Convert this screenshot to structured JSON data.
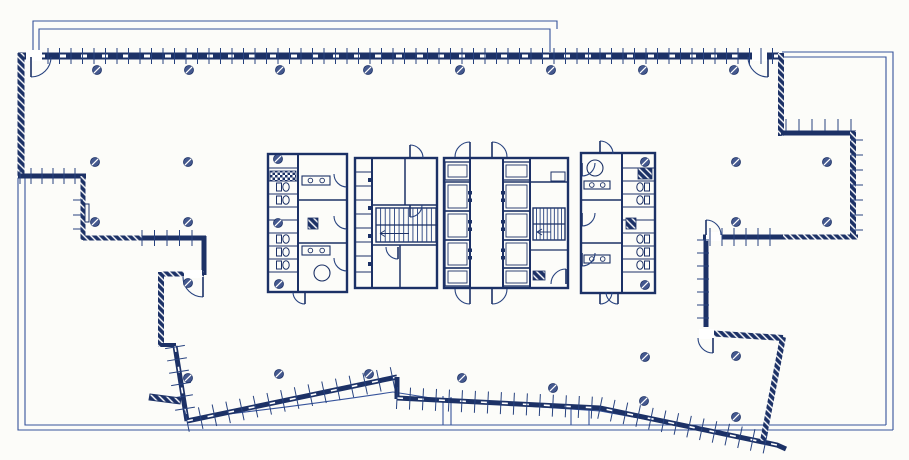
{
  "meta": {
    "drawing_type": "architectural-floor-plan",
    "style": "blueprint-linework"
  },
  "canvas": {
    "w": 909,
    "h": 460
  },
  "colors": {
    "background": "#fcfcf9",
    "wall": "#1c3166",
    "medium": "#27427f",
    "thin": "#36539b",
    "column_fill": "#44588e",
    "white": "#ffffff"
  },
  "thin_lines": [
    {
      "pts": [
        [
          33,
          53
        ],
        [
          33,
          21
        ],
        [
          557,
          21
        ],
        [
          557,
          29
        ]
      ]
    },
    {
      "pts": [
        [
          39,
          53
        ],
        [
          39,
          29
        ],
        [
          550,
          29
        ],
        [
          550,
          52
        ]
      ]
    },
    {
      "pts": [
        [
          782,
          52
        ],
        [
          893,
          52
        ],
        [
          893,
          430
        ]
      ]
    },
    {
      "pts": [
        [
          782,
          57
        ],
        [
          886,
          57
        ],
        [
          886,
          425
        ]
      ]
    },
    {
      "pts": [
        [
          18,
          178
        ],
        [
          18,
          430
        ],
        [
          893,
          430
        ]
      ]
    },
    {
      "pts": [
        [
          25,
          178
        ],
        [
          25,
          425
        ],
        [
          886,
          425
        ]
      ]
    },
    {
      "pts": [
        [
          393,
          392
        ],
        [
          450,
          401
        ],
        [
          600,
          411
        ],
        [
          765,
          441
        ]
      ]
    },
    {
      "pts": [
        [
          443,
          396
        ],
        [
          443,
          425
        ]
      ]
    },
    {
      "pts": [
        [
          451,
          397
        ],
        [
          451,
          425
        ]
      ]
    },
    {
      "pts": [
        [
          571,
          409
        ],
        [
          571,
          425
        ]
      ]
    },
    {
      "pts": [
        [
          589,
          410
        ],
        [
          589,
          425
        ]
      ]
    }
  ],
  "thin_paths": [
    {
      "d": "M195,418 Q300,406 393,392"
    }
  ],
  "walls": [
    {
      "pts": [
        [
          18,
          56
        ],
        [
          779,
          56
        ]
      ],
      "w": 7,
      "paint": "solid",
      "dash": true
    },
    {
      "pts": [
        [
          21,
          53
        ],
        [
          21,
          178
        ]
      ],
      "w": 7,
      "paint": "hatch"
    },
    {
      "pts": [
        [
          18,
          176
        ],
        [
          86,
          176
        ]
      ],
      "w": 5,
      "paint": "solid"
    },
    {
      "pts": [
        [
          83,
          176
        ],
        [
          83,
          240
        ]
      ],
      "w": 5,
      "paint": "hatch"
    },
    {
      "pts": [
        [
          83,
          238
        ],
        [
          142,
          238
        ]
      ],
      "w": 5,
      "paint": "hatch"
    },
    {
      "pts": [
        [
          142,
          238
        ],
        [
          206,
          238
        ]
      ],
      "w": 5,
      "paint": "solid"
    },
    {
      "pts": [
        [
          204,
          236
        ],
        [
          204,
          275
        ]
      ],
      "w": 5,
      "paint": "solid"
    },
    {
      "pts": [
        [
          162,
          274
        ],
        [
          204,
          274
        ]
      ],
      "w": 5,
      "paint": "hatch"
    },
    {
      "pts": [
        [
          161,
          272
        ],
        [
          161,
          347
        ]
      ],
      "w": 6,
      "paint": "hatch"
    },
    {
      "pts": [
        [
          161,
          345
        ],
        [
          176,
          345
        ]
      ],
      "w": 4,
      "paint": "solid"
    },
    {
      "pts": [
        [
          175,
          346
        ],
        [
          187,
          421
        ]
      ],
      "w": 5,
      "paint": "solid",
      "dash": true
    },
    {
      "pts": [
        [
          187,
          421
        ],
        [
          397,
          377
        ]
      ],
      "w": 5,
      "paint": "solid",
      "dash": true
    },
    {
      "pts": [
        [
          397,
          377
        ],
        [
          397,
          399
        ]
      ],
      "w": 5,
      "paint": "solid"
    },
    {
      "pts": [
        [
          397,
          398
        ],
        [
          600,
          408
        ],
        [
          777,
          445
        ],
        [
          786,
          449
        ]
      ],
      "w": 5,
      "paint": "solid",
      "dash": true
    },
    {
      "pts": [
        [
          783,
          337
        ],
        [
          763,
          441
        ]
      ],
      "w": 6,
      "paint": "hatch"
    },
    {
      "pts": [
        [
          706,
          333
        ],
        [
          783,
          338
        ]
      ],
      "w": 6,
      "paint": "hatch"
    },
    {
      "pts": [
        [
          706,
          240
        ],
        [
          706,
          327
        ]
      ],
      "w": 5,
      "paint": "solid"
    },
    {
      "pts": [
        [
          703,
          237
        ],
        [
          783,
          237
        ]
      ],
      "w": 5,
      "paint": "solid"
    },
    {
      "pts": [
        [
          783,
          237
        ],
        [
          858,
          237
        ]
      ],
      "w": 5,
      "paint": "hatch"
    },
    {
      "pts": [
        [
          781,
          53
        ],
        [
          781,
          136
        ]
      ],
      "w": 6,
      "paint": "hatch"
    },
    {
      "pts": [
        [
          781,
          133
        ],
        [
          856,
          133
        ]
      ],
      "w": 5,
      "paint": "solid"
    },
    {
      "pts": [
        [
          853,
          131
        ],
        [
          853,
          238
        ]
      ],
      "w": 6,
      "paint": "hatch"
    }
  ],
  "white_gaps": [
    [
      26,
      50,
      16,
      11
    ],
    [
      752,
      50,
      15,
      11
    ],
    [
      184,
      270,
      18,
      8
    ],
    [
      699,
      329,
      15,
      10
    ],
    [
      706,
      232,
      16,
      9
    ]
  ],
  "tick_sets": [
    [
      48,
      56,
      776,
      56,
      11.5,
      8,
      8
    ],
    [
      20,
      176,
      84,
      176,
      11,
      8,
      8
    ],
    [
      142,
      238,
      204,
      238,
      12.5,
      8,
      8
    ],
    [
      175,
      347,
      187,
      421,
      12.5,
      10,
      10
    ],
    [
      187,
      421,
      397,
      377,
      14,
      11,
      11
    ],
    [
      397,
      398,
      600,
      408,
      13,
      11,
      11
    ],
    [
      600,
      408,
      777,
      445,
      13,
      11,
      11
    ],
    [
      706,
      240,
      706,
      326,
      13,
      9,
      3
    ],
    [
      710,
      237,
      780,
      237,
      12,
      9,
      9
    ],
    [
      786,
      129,
      852,
      129,
      13,
      2,
      10
    ],
    [
      853,
      140,
      853,
      232,
      15,
      2,
      10
    ]
  ],
  "small_ticks": [
    [
      73,
      200,
      83,
      200
    ],
    [
      73,
      215,
      83,
      215
    ],
    [
      73,
      229,
      83,
      229
    ]
  ],
  "doors": [
    [
      31,
      57,
      20,
      90,
      0,
      0,
      90
    ],
    [
      768,
      57,
      20,
      90,
      180,
      1,
      90
    ],
    [
      203,
      277,
      20,
      90,
      180,
      1,
      90
    ],
    [
      713,
      338,
      15,
      90,
      180,
      1,
      90
    ],
    [
      706,
      235,
      15,
      270,
      360,
      1,
      270
    ],
    [
      470,
      157,
      15,
      270,
      180,
      0,
      270
    ],
    [
      492,
      157,
      15,
      270,
      360,
      1,
      270
    ],
    [
      470,
      289,
      15,
      90,
      180,
      1,
      90
    ],
    [
      492,
      289,
      15,
      90,
      0,
      0,
      90
    ],
    [
      410,
      158,
      13,
      270,
      360,
      1,
      270
    ],
    [
      600,
      154,
      13,
      270,
      360,
      1,
      270
    ],
    [
      600,
      292,
      12,
      90,
      0,
      0,
      90
    ],
    [
      305,
      292,
      12,
      90,
      180,
      1,
      90
    ],
    [
      347,
      174,
      13,
      90,
      180,
      1,
      90
    ],
    [
      347,
      216,
      13,
      90,
      180,
      1,
      90
    ],
    [
      347,
      258,
      13,
      90,
      180,
      1,
      90
    ],
    [
      410,
      205,
      12,
      0,
      90,
      1,
      90
    ],
    [
      398,
      247,
      12,
      90,
      180,
      1,
      90
    ],
    [
      566,
      284,
      15,
      180,
      270,
      1,
      270
    ],
    [
      582,
      163,
      13,
      0,
      90,
      1,
      90
    ],
    [
      582,
      213,
      13,
      0,
      90,
      1,
      90
    ],
    [
      582,
      253,
      13,
      0,
      90,
      1,
      90
    ],
    [
      618,
      292,
      12,
      90,
      180,
      1,
      90
    ]
  ],
  "columns": {
    "r": 4.5,
    "pts": [
      [
        97,
        70
      ],
      [
        189,
        70
      ],
      [
        280,
        70
      ],
      [
        368,
        70
      ],
      [
        460,
        70
      ],
      [
        551,
        70
      ],
      [
        643,
        70
      ],
      [
        734,
        70
      ],
      [
        95,
        162
      ],
      [
        188,
        162
      ],
      [
        278,
        159
      ],
      [
        645,
        162
      ],
      [
        736,
        162
      ],
      [
        827,
        162
      ],
      [
        95,
        222
      ],
      [
        188,
        222
      ],
      [
        278,
        223
      ],
      [
        736,
        222
      ],
      [
        827,
        222
      ],
      [
        188,
        283
      ],
      [
        279,
        284
      ],
      [
        645,
        285
      ],
      [
        645,
        357
      ],
      [
        736,
        356
      ],
      [
        188,
        378
      ],
      [
        279,
        374
      ],
      [
        369,
        374
      ],
      [
        462,
        378
      ],
      [
        553,
        388
      ],
      [
        644,
        401
      ],
      [
        736,
        417
      ]
    ]
  },
  "core": {
    "rects": [
      [
        268,
        154,
        79,
        138,
        2.4
      ],
      [
        355,
        158,
        82,
        130,
        2.4
      ],
      [
        444,
        158,
        124,
        130,
        2.4
      ],
      [
        581,
        153,
        74,
        140,
        2.4
      ],
      [
        551,
        172,
        14,
        9,
        1
      ],
      [
        85,
        204,
        4,
        18,
        1
      ]
    ],
    "lines": [
      [
        298,
        154,
        298,
        292,
        2
      ],
      [
        268,
        168,
        298,
        168,
        1.1
      ],
      [
        268,
        181,
        298,
        181,
        1.1
      ],
      [
        268,
        194,
        298,
        194,
        1.1
      ],
      [
        268,
        207,
        298,
        207,
        1.1
      ],
      [
        268,
        220,
        298,
        220,
        1.1
      ],
      [
        268,
        233,
        298,
        233,
        1.1
      ],
      [
        268,
        246,
        298,
        246,
        1.1
      ],
      [
        268,
        259,
        298,
        259,
        1.1
      ],
      [
        268,
        272,
        298,
        272,
        1.1
      ],
      [
        298,
        200,
        347,
        200,
        1.5
      ],
      [
        298,
        243,
        347,
        243,
        1.5
      ],
      [
        372,
        158,
        372,
        288,
        2
      ],
      [
        355,
        172,
        372,
        172,
        1.1
      ],
      [
        355,
        186,
        372,
        186,
        1.1
      ],
      [
        355,
        200,
        372,
        200,
        1.1
      ],
      [
        355,
        214,
        372,
        214,
        1.1
      ],
      [
        355,
        228,
        372,
        228,
        1.1
      ],
      [
        355,
        242,
        372,
        242,
        1.1
      ],
      [
        355,
        256,
        372,
        256,
        1.1
      ],
      [
        355,
        272,
        372,
        272,
        1.1
      ],
      [
        372,
        205,
        437,
        205,
        1.5
      ],
      [
        372,
        245,
        437,
        245,
        1.5
      ],
      [
        405,
        158,
        405,
        205,
        1.5
      ],
      [
        400,
        245,
        400,
        288,
        1.5
      ],
      [
        470,
        158,
        470,
        288,
        2
      ],
      [
        503,
        158,
        503,
        288,
        2
      ],
      [
        530,
        158,
        530,
        288,
        2
      ],
      [
        444,
        182,
        470,
        182,
        1.3
      ],
      [
        444,
        211,
        470,
        211,
        1.3
      ],
      [
        444,
        240,
        470,
        240,
        1.3
      ],
      [
        444,
        268,
        470,
        268,
        1.3
      ],
      [
        503,
        182,
        530,
        182,
        1.3
      ],
      [
        503,
        211,
        530,
        211,
        1.3
      ],
      [
        503,
        240,
        530,
        240,
        1.3
      ],
      [
        503,
        268,
        530,
        268,
        1.3
      ],
      [
        530,
        182,
        568,
        182,
        1.5
      ],
      [
        530,
        250,
        568,
        250,
        1.2
      ],
      [
        622,
        153,
        622,
        293,
        2
      ],
      [
        622,
        168,
        655,
        168,
        1.1
      ],
      [
        622,
        181,
        655,
        181,
        1.1
      ],
      [
        622,
        194,
        655,
        194,
        1.1
      ],
      [
        622,
        207,
        655,
        207,
        1.1
      ],
      [
        622,
        220,
        655,
        220,
        1.1
      ],
      [
        622,
        233,
        655,
        233,
        1.1
      ],
      [
        622,
        246,
        655,
        246,
        1.1
      ],
      [
        622,
        259,
        655,
        259,
        1.1
      ],
      [
        622,
        272,
        655,
        272,
        1.1
      ],
      [
        581,
        200,
        622,
        200,
        1.5
      ],
      [
        581,
        243,
        622,
        243,
        1.5
      ]
    ],
    "elevators": [
      [
        445,
        182,
        25,
        29,
        "r"
      ],
      [
        445,
        211,
        25,
        29,
        "r"
      ],
      [
        445,
        240,
        25,
        28,
        "r"
      ],
      [
        503,
        182,
        27,
        29,
        "l"
      ],
      [
        503,
        211,
        27,
        29,
        "l"
      ],
      [
        503,
        240,
        27,
        28,
        "l"
      ],
      [
        445,
        162,
        25,
        18,
        "n"
      ],
      [
        503,
        162,
        27,
        18,
        "n"
      ],
      [
        445,
        268,
        25,
        18,
        "n"
      ],
      [
        503,
        268,
        27,
        18,
        "n"
      ]
    ],
    "stairs": [
      [
        376,
        208,
        60,
        34,
        13
      ],
      [
        533,
        208,
        32,
        32,
        9
      ]
    ],
    "wcs": [
      [
        286,
        187,
        "l"
      ],
      [
        286,
        200,
        "l"
      ],
      [
        286,
        239,
        "l"
      ],
      [
        286,
        252,
        "l"
      ],
      [
        286,
        265,
        "l"
      ],
      [
        640,
        187,
        "r"
      ],
      [
        640,
        200,
        "r"
      ],
      [
        640,
        239,
        "r"
      ],
      [
        640,
        252,
        "r"
      ],
      [
        640,
        265,
        "r"
      ]
    ],
    "sinks": [
      [
        302,
        176,
        28,
        9
      ],
      [
        302,
        246,
        28,
        9
      ],
      [
        584,
        181,
        26,
        8
      ],
      [
        584,
        255,
        26,
        8
      ]
    ],
    "circles": [
      [
        322,
        273,
        8
      ],
      [
        595,
        168,
        8
      ]
    ],
    "hatch_rects": [
      [
        308,
        218,
        10,
        11
      ],
      [
        626,
        218,
        10,
        11
      ],
      [
        533,
        271,
        12,
        9
      ],
      [
        638,
        168,
        14,
        11
      ]
    ],
    "checker_rects": [
      [
        270,
        171,
        26,
        10
      ]
    ],
    "jambs": [
      [
        368,
        178,
        4,
        4
      ],
      [
        368,
        206,
        4,
        4
      ],
      [
        368,
        234,
        4,
        4
      ],
      [
        368,
        262,
        4,
        4
      ]
    ],
    "slabs": [
      [
        [
          150,
          394
        ],
        [
          181,
          398
        ],
        [
          180,
          404
        ],
        [
          149,
          400
        ]
      ]
    ]
  }
}
